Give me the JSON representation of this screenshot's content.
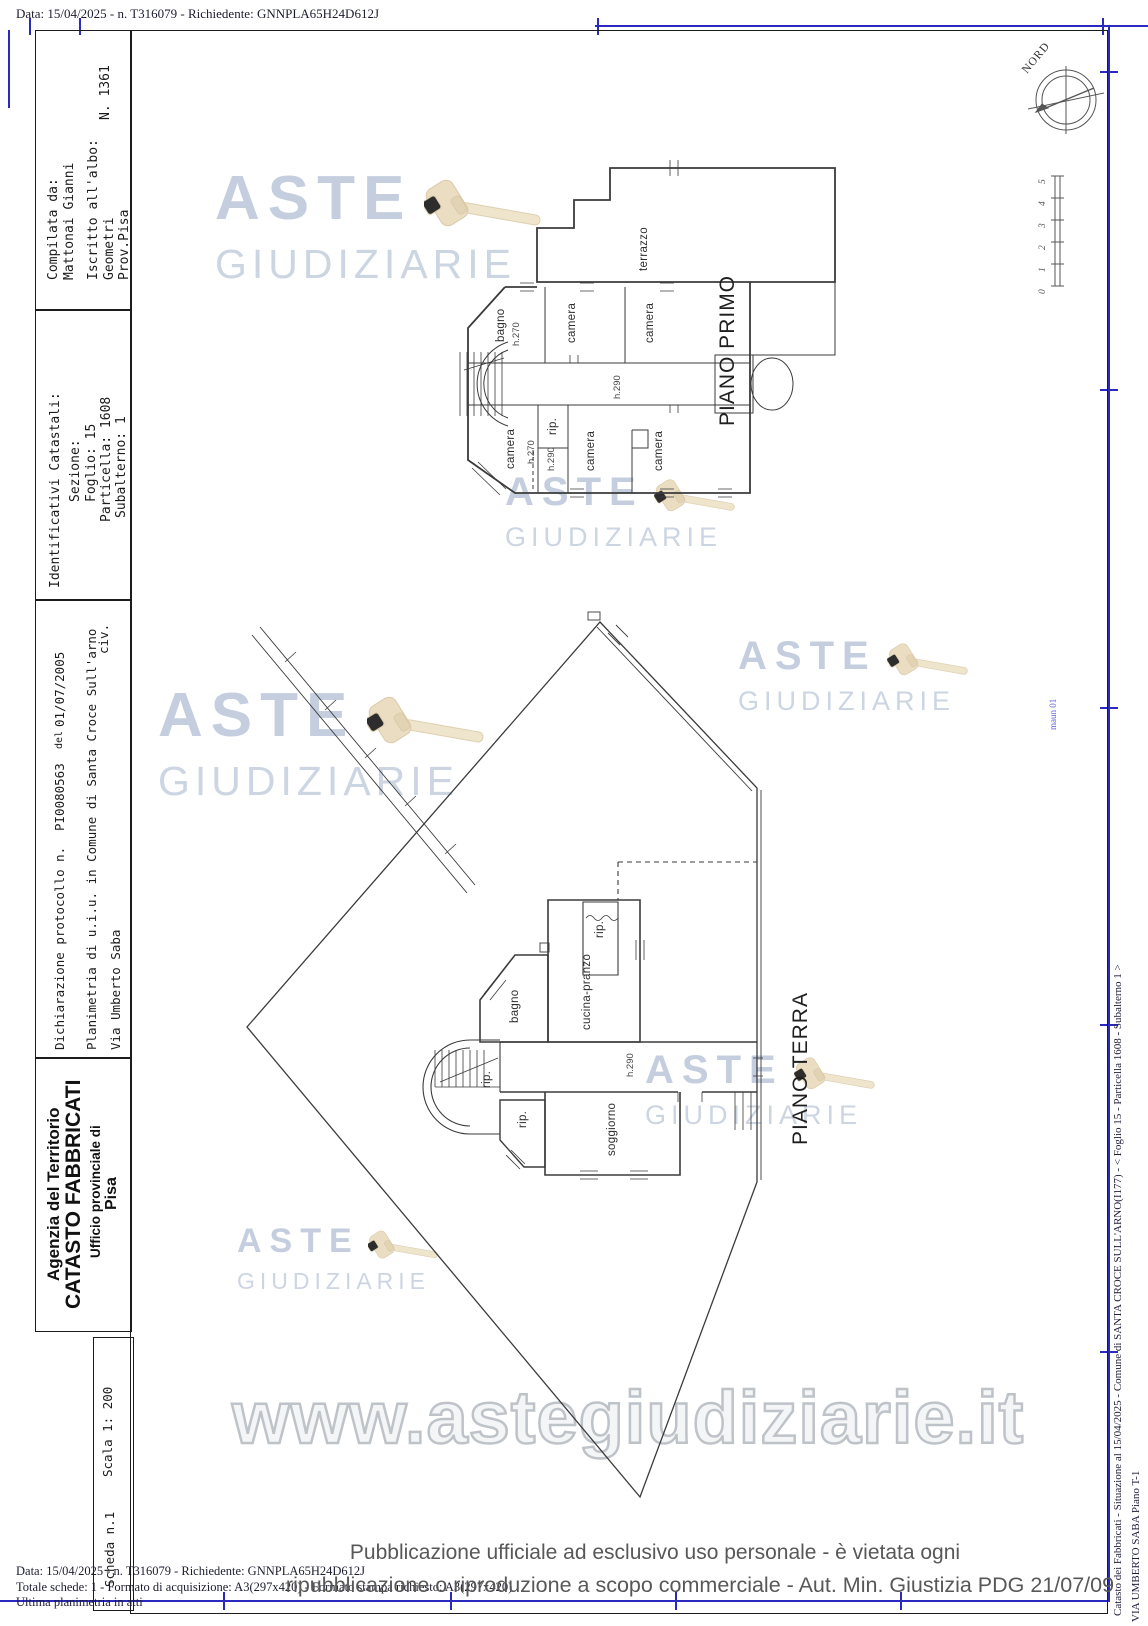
{
  "header": {
    "top_line": "Data: 15/04/2025 - n. T316079 - Richiedente: GNNPLA65H24D612J"
  },
  "left_panel": {
    "compiler": {
      "line1": "Compilata da:",
      "line2": "Mattonai Gianni",
      "line3": "Iscritto all'albo:",
      "line4": "Geometri",
      "line5": "Prov.Pisa",
      "number": "N. 1361"
    },
    "catastal": {
      "title": "Identificativi Catastali:",
      "sezione": "Sezione:",
      "foglio": "Foglio: 15",
      "particella": "Particella: 1608",
      "subalterno": "Subalterno: 1"
    },
    "declaration": {
      "prefix": "Dichiarazione protocollo n.",
      "protocol": "PI0080563",
      "del": "del",
      "date": "01/07/2005",
      "line2": "Planimetria di u.i.u. in Comune di Santa Croce Sull'arno",
      "street": "Via Umberto Saba",
      "civ": "civ."
    },
    "agency": {
      "line1": "Agenzia del Territorio",
      "line2": "CATASTO FABBRICATI",
      "line3": "Ufficio provinciale di",
      "line4": "Pisa"
    },
    "scale_box": {
      "scala": "Scala 1: 200",
      "scheda": "Scheda n.1"
    }
  },
  "plans": {
    "primo": {
      "title": "PIANO PRIMO",
      "labels": {
        "terrazzo": "terrazzo",
        "bagno": "bagno",
        "bagno_h": "h.270",
        "camera_top_1": "camera",
        "camera_top_2": "camera",
        "corridoio_h": "h.290",
        "camera_bl": "camera",
        "camera_bl_h1": "h.270",
        "camera_bl_h2": "h.290",
        "rip": "rip.",
        "camera_bm": "camera",
        "camera_br": "camera"
      }
    },
    "terra": {
      "title": "PIANO TERRA",
      "labels": {
        "rip_top": "rip.",
        "bagno": "bagno",
        "cucina": "cucina-pranzo",
        "rip_scale": "rip.",
        "rip_basso": "rip.",
        "soggiorno": "soggiorno",
        "corridoio_h": "h.290"
      }
    }
  },
  "compass": {
    "label": "NORD"
  },
  "scale_bar": {
    "ticks": [
      "5",
      "4",
      "3",
      "2",
      "1",
      "0"
    ]
  },
  "right_margin": {
    "line1": "Catasto dei Fabbricati - Situazione al 15/04/2025 - Comune di SANTA CROCE SULL'ARNO(I177) - <  Foglio 15 - Particella 1608 - Subalterno 1 >",
    "line2": "VIA UMBERTO SABA Piano T-1",
    "note": "maun 01"
  },
  "watermark": {
    "word1": "ASTE",
    "word2": "GIUDIZIARIE",
    "url": "www.astegiudiziarie.it"
  },
  "footer": {
    "line1": "Pubblicazione ufficiale ad esclusivo uso personale - è vietata ogni",
    "line2": "ripubblicazione o riproduzione a scopo commerciale - Aut. Min. Giustizia PDG 21/07/09",
    "small1": "Data: 15/04/2025 - n. T316079 - Richiedente: GNNPLA65H24D612J",
    "small2": "Totale schede: 1 - Formato di acquisizione: A3(297x420) - Formato stampa richiesto: A3(297x420)",
    "small3": "Ultima planimetria in atti"
  }
}
